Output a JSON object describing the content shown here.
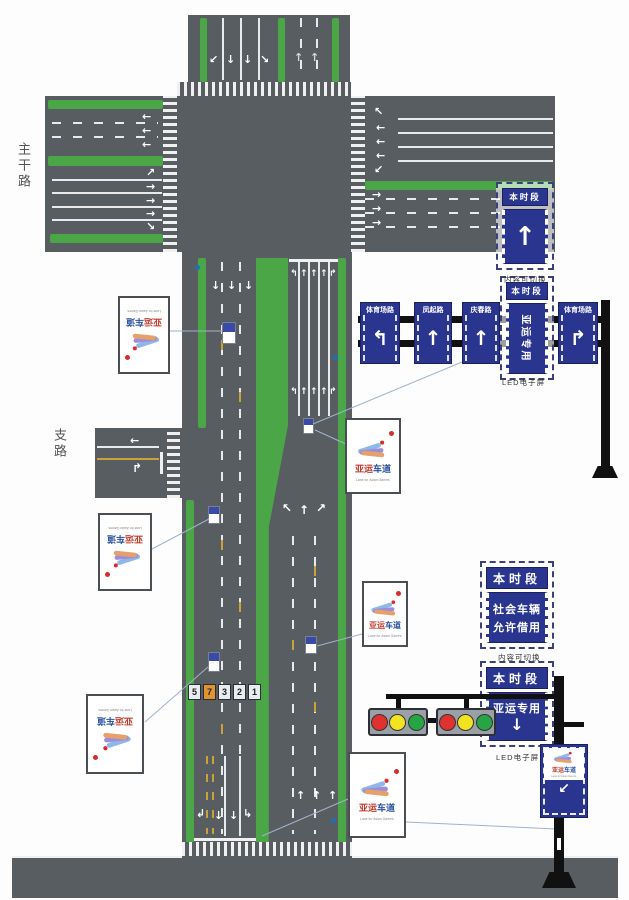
{
  "colors": {
    "road": "#585d62",
    "lane_green": "#4ba648",
    "sign_blue": "#2a3590",
    "marking_yellow": "#c9a23a"
  },
  "labels": {
    "main_road": "主干路",
    "branch_road": "支路"
  },
  "captions": {
    "switchable_top": "内容可切换",
    "led_top": "LED电子屏",
    "switchable_right": "内容可切换",
    "led_right": "LED电子屏"
  },
  "top_led_sign": {
    "header": "本时段",
    "arrow": "↑"
  },
  "overhead_signs": {
    "sign1": {
      "road": "体育场路",
      "arrow": "↰"
    },
    "sign2": {
      "road": "凤起路",
      "arrow": "↑"
    },
    "sign3": {
      "road": "庆春路",
      "arrow": "↑"
    },
    "sign4": {
      "header": "本时段",
      "body": "亚运专用"
    },
    "sign5": {
      "road": "体育场路",
      "arrow": "↱"
    }
  },
  "right_led_group": {
    "sign_borrow": {
      "header": "本时段",
      "line1": "社会车辆",
      "line2": "允许借用"
    },
    "sign_dedicated": {
      "header": "本时段",
      "body": "亚运专用",
      "arrow": "↓"
    }
  },
  "asian_games_sign": {
    "title_part1": "亚运",
    "title_part2": "车道",
    "subtitle": "Lane for Asian Games"
  },
  "pole_sign": {
    "title_part1": "亚运",
    "title_part2": "车道",
    "subtitle": "Lane for Asian Games",
    "arrow": "↙"
  },
  "lane_numbers": [
    "5",
    "7",
    "3",
    "2",
    "1"
  ],
  "arrows": {
    "up": "↑",
    "down": "↓",
    "left": "←",
    "right": "→",
    "up_left": "↖",
    "up_right": "↗",
    "down_left": "↙",
    "down_right": "↘",
    "turn_left": "↰",
    "turn_right": "↱",
    "turn_down_left": "↲",
    "turn_down_right": "↳"
  }
}
